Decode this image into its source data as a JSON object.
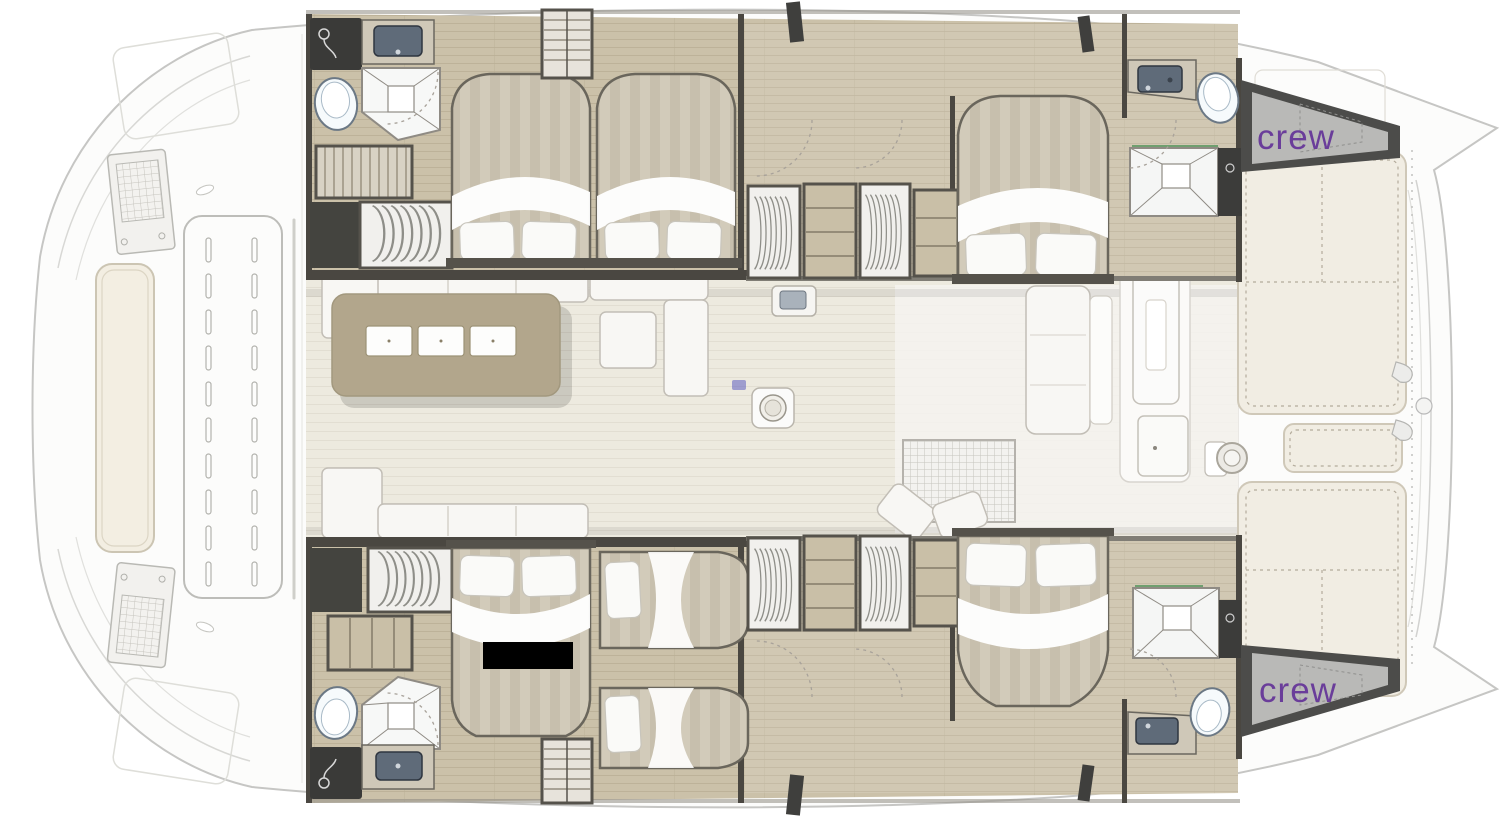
{
  "labels": {
    "crew_top": "crew",
    "crew_bottom": "crew"
  },
  "colors": {
    "crew_text": "#6a3d9a",
    "hull_floor": "#cbc1a9",
    "salon_floor": "#edeadf",
    "galley_island": "#b2a68c",
    "wall_dark": "#4a4741",
    "locker_dark": "#3c3c3a",
    "mattress": "#d2cbba",
    "pillow": "#fafaf8",
    "cushion": "#f1ede3",
    "deck_white": "#fcfcfb",
    "outline_gray": "#c6c6c4",
    "redaction_black": "#000000",
    "watermark_blue": "#5c5cc0"
  }
}
